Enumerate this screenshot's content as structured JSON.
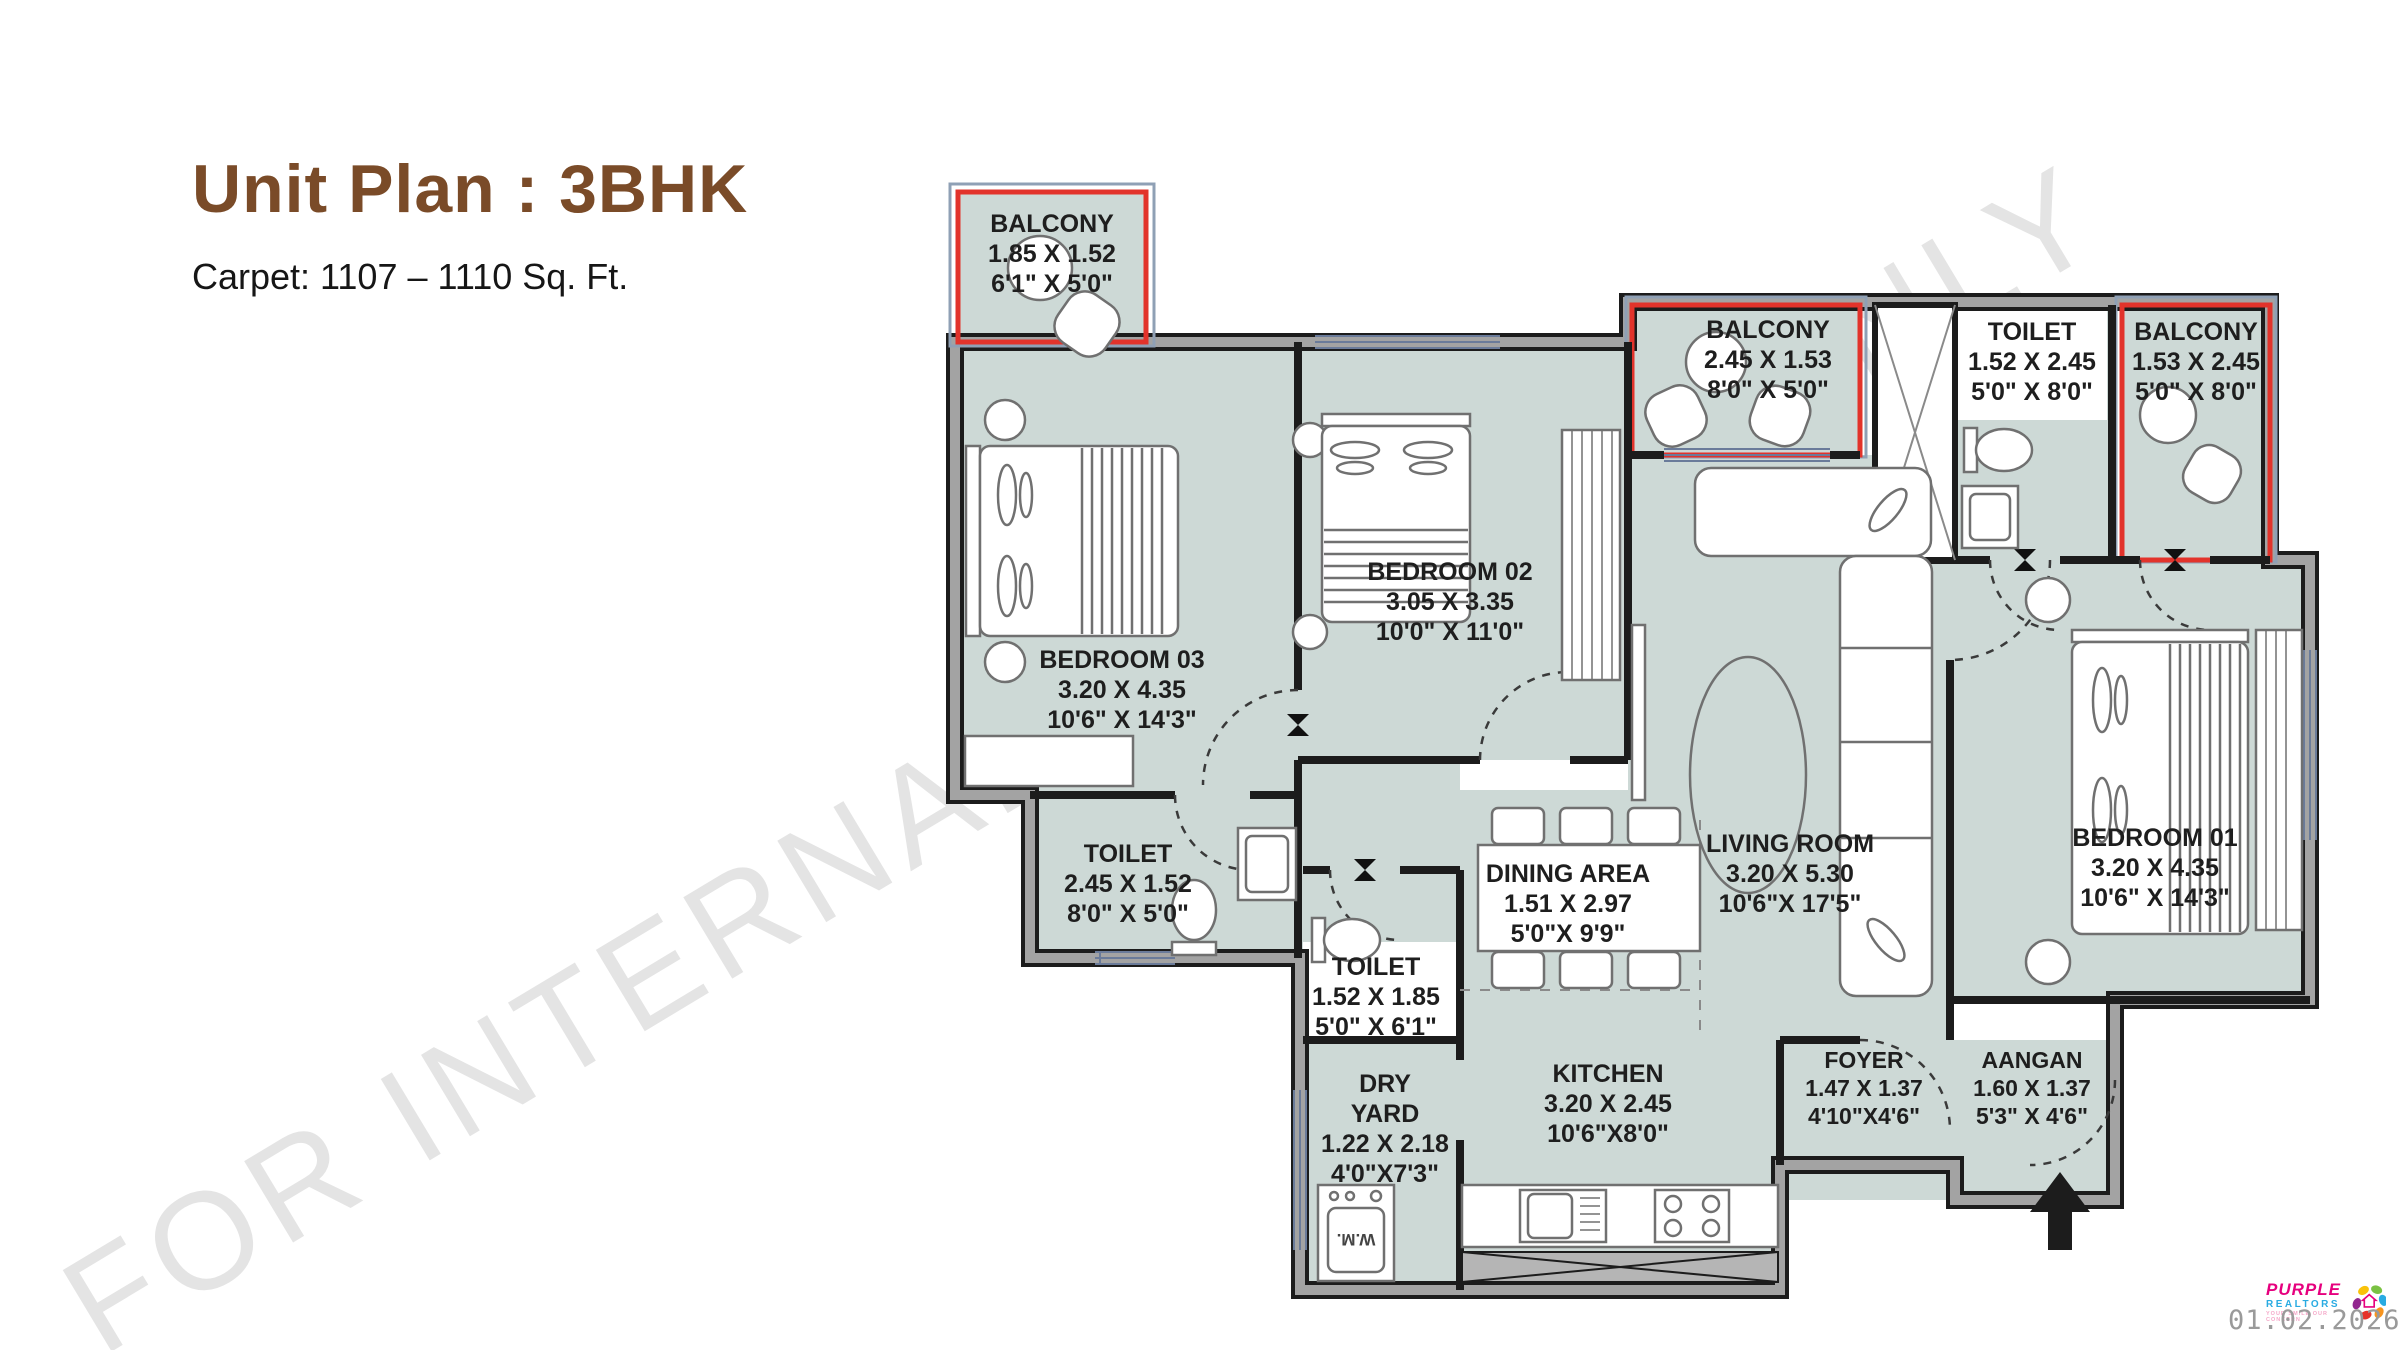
{
  "header": {
    "title": "Unit Plan : 3BHK",
    "subtitle": "Carpet: 1107 – 1110 Sq. Ft.",
    "title_color": "#7a4b28"
  },
  "watermark": {
    "part1": "FOR INTERNAL",
    "part2": "ONLY",
    "color": "#e4e4e4"
  },
  "colors": {
    "floor": "#cdd9d6",
    "wall_gray": "#a3a3a3",
    "wall_dark": "#1c1c1c",
    "balcony_outline": "#e2332b",
    "window_blue": "#6a7b9a"
  },
  "rooms": [
    {
      "id": "balcony-top-left",
      "name": "BALCONY",
      "dim_m": "1.85 X 1.52",
      "dim_ft": "6'1\" X 5'0\""
    },
    {
      "id": "bedroom-03",
      "name": "BEDROOM 03",
      "dim_m": "3.20 X 4.35",
      "dim_ft": "10'6\" X 14'3\""
    },
    {
      "id": "bedroom-02",
      "name": "BEDROOM 02",
      "dim_m": "3.05 X 3.35",
      "dim_ft": "10'0\" X 11'0\""
    },
    {
      "id": "balcony-mid",
      "name": "BALCONY",
      "dim_m": "2.45 X 1.53",
      "dim_ft": "8'0\" X 5'0\""
    },
    {
      "id": "toilet-top",
      "name": "TOILET",
      "dim_m": "1.52 X 2.45",
      "dim_ft": "5'0\" X 8'0\""
    },
    {
      "id": "balcony-right",
      "name": "BALCONY",
      "dim_m": "1.53 X 2.45",
      "dim_ft": "5'0\" X 8'0\""
    },
    {
      "id": "toilet-left",
      "name": "TOILET",
      "dim_m": "2.45 X 1.52",
      "dim_ft": "8'0\" X 5'0\""
    },
    {
      "id": "toilet-mid",
      "name": "TOILET",
      "dim_m": "1.52 X 1.85",
      "dim_ft": "5'0\" X 6'1\""
    },
    {
      "id": "dining-area",
      "name": "DINING AREA",
      "dim_m": "1.51 X 2.97",
      "dim_ft": "5'0\"X 9'9\""
    },
    {
      "id": "living-room",
      "name": "LIVING ROOM",
      "dim_m": "3.20 X 5.30",
      "dim_ft": "10'6\"X 17'5\""
    },
    {
      "id": "bedroom-01",
      "name": "BEDROOM 01",
      "dim_m": "3.20 X 4.35",
      "dim_ft": "10'6\" X 14'3\""
    },
    {
      "id": "kitchen",
      "name": "KITCHEN",
      "dim_m": "3.20 X 2.45",
      "dim_ft": "10'6\"X8'0\""
    },
    {
      "id": "dry-yard",
      "name_line1": "DRY",
      "name_line2": "YARD",
      "dim_m": "1.22 X 2.18",
      "dim_ft": "4'0\"X7'3\""
    },
    {
      "id": "foyer",
      "name": "FOYER",
      "dim_m": "1.47 X 1.37",
      "dim_ft": "4'10\"X4'6\""
    },
    {
      "id": "aangan",
      "name": "AANGAN",
      "dim_m": "1.60 X 1.37",
      "dim_ft": "5'3\" X 4'6\""
    }
  ],
  "annotations": {
    "washing_machine": "W.M."
  },
  "footer": {
    "date": "01.02.2026",
    "logo_line1": "PURPLE",
    "logo_line2": "REALTORS",
    "logo_line3": "YOUR SMILE OUR CONCERN"
  }
}
